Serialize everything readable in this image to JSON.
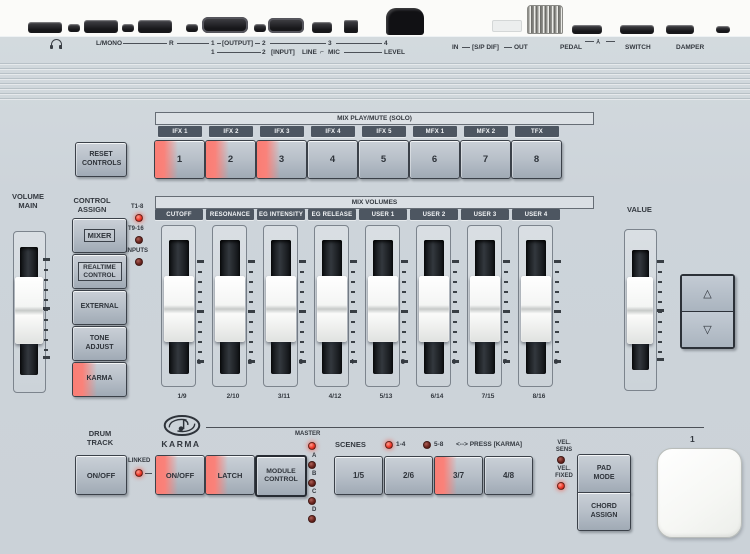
{
  "colors": {
    "panel": "#cdd4da",
    "label_bar": "#4d5661",
    "led_on": "#ee392a",
    "led_off": "#6d2620",
    "button_glow": "#fa827a"
  },
  "rear": {
    "l_mono": "L/MONO",
    "r": "R",
    "out1": "1",
    "output": "[OUTPUT]",
    "out2": "2",
    "out3": "3",
    "out4": "4",
    "in1": "1",
    "in2": "2",
    "input": "[INPUT]",
    "line": "LINE",
    "mic": "MIC",
    "level": "LEVEL",
    "spdif_in": "IN",
    "spdif": "[S/P DIF]",
    "spdif_out": "OUT",
    "pedal": "PEDAL",
    "switch": "SWITCH",
    "damper": "DAMPER"
  },
  "icons": {
    "up_triangle": "△",
    "down_triangle": "▽",
    "line_mic_switch": "⌐",
    "pedal_polarity": "Y"
  },
  "reset_controls": {
    "label": "RESET CONTROLS"
  },
  "mix_play_mute": {
    "title": "MIX PLAY/MUTE (SOLO)",
    "labels": [
      "IFX 1",
      "IFX 2",
      "IFX 3",
      "IFX 4",
      "IFX 5",
      "MFX 1",
      "MFX 2",
      "TFX"
    ],
    "buttons": [
      {
        "label": "1",
        "lit": true
      },
      {
        "label": "2",
        "lit": true
      },
      {
        "label": "3",
        "lit": true
      },
      {
        "label": "4",
        "lit": false
      },
      {
        "label": "5",
        "lit": false
      },
      {
        "label": "6",
        "lit": false
      },
      {
        "label": "7",
        "lit": false
      },
      {
        "label": "8",
        "lit": false
      }
    ]
  },
  "volume_main": {
    "label": "VOLUME MAIN"
  },
  "control_assign": {
    "title": "CONTROL ASSIGN",
    "leds": [
      {
        "label": "T1-8",
        "on": true
      },
      {
        "label": "T9-16",
        "on": false
      },
      {
        "label": "INPUTS",
        "on": false
      }
    ],
    "buttons": [
      {
        "label": "MIXER",
        "lit": false
      },
      {
        "label": "REALTIME CONTROL",
        "lit": false
      },
      {
        "label": "EXTERNAL",
        "lit": false
      },
      {
        "label": "TONE ADJUST",
        "lit": false
      },
      {
        "label": "KARMA",
        "lit": true
      }
    ]
  },
  "mix_volumes": {
    "title": "MIX VOLUMES",
    "labels": [
      "CUTOFF",
      "RESONANCE",
      "EG INTENSITY",
      "EG RELEASE",
      "USER 1",
      "USER 2",
      "USER 3",
      "USER 4"
    ],
    "sliders": [
      {
        "number": "1",
        "pair": "1/9"
      },
      {
        "number": "2",
        "pair": "2/10"
      },
      {
        "number": "3",
        "pair": "3/11"
      },
      {
        "number": "4",
        "pair": "4/12"
      },
      {
        "number": "5",
        "pair": "5/13"
      },
      {
        "number": "6",
        "pair": "6/14"
      },
      {
        "number": "7",
        "pair": "7/15"
      },
      {
        "number": "8",
        "pair": "8/16"
      }
    ]
  },
  "value_section": {
    "label": "VALUE"
  },
  "drum_track": {
    "title": "DRUM TRACK",
    "button": "ON/OFF",
    "linked": "LINKED"
  },
  "karma": {
    "name": "KARMA",
    "buttons": [
      {
        "label": "ON/OFF",
        "lit": true
      },
      {
        "label": "LATCH",
        "lit": true
      },
      {
        "label": "MODULE CONTROL",
        "lit": false
      }
    ],
    "master": {
      "label": "MASTER",
      "on": true,
      "modules": [
        {
          "label": "A",
          "on": false
        },
        {
          "label": "B",
          "on": false
        },
        {
          "label": "C",
          "on": false
        },
        {
          "label": "D",
          "on": false
        }
      ]
    },
    "scenes": {
      "title": "SCENES",
      "group_1_4": {
        "label": "1-4",
        "on": true
      },
      "group_5_8": {
        "label": "5-8",
        "on": false
      },
      "hint": "<--> PRESS [KARMA]",
      "buttons": [
        {
          "label": "1/5",
          "lit": false
        },
        {
          "label": "2/6",
          "lit": false
        },
        {
          "label": "3/7",
          "lit": true
        },
        {
          "label": "4/8",
          "lit": false
        }
      ]
    }
  },
  "pads": {
    "vel_sens": {
      "label": "VEL. SENS",
      "on": false
    },
    "vel_fixed": {
      "label": "VEL. FIXED",
      "on": true
    },
    "pad_mode": "PAD MODE",
    "chord_assign": "CHORD ASSIGN",
    "pad_1": {
      "label": "1"
    }
  }
}
